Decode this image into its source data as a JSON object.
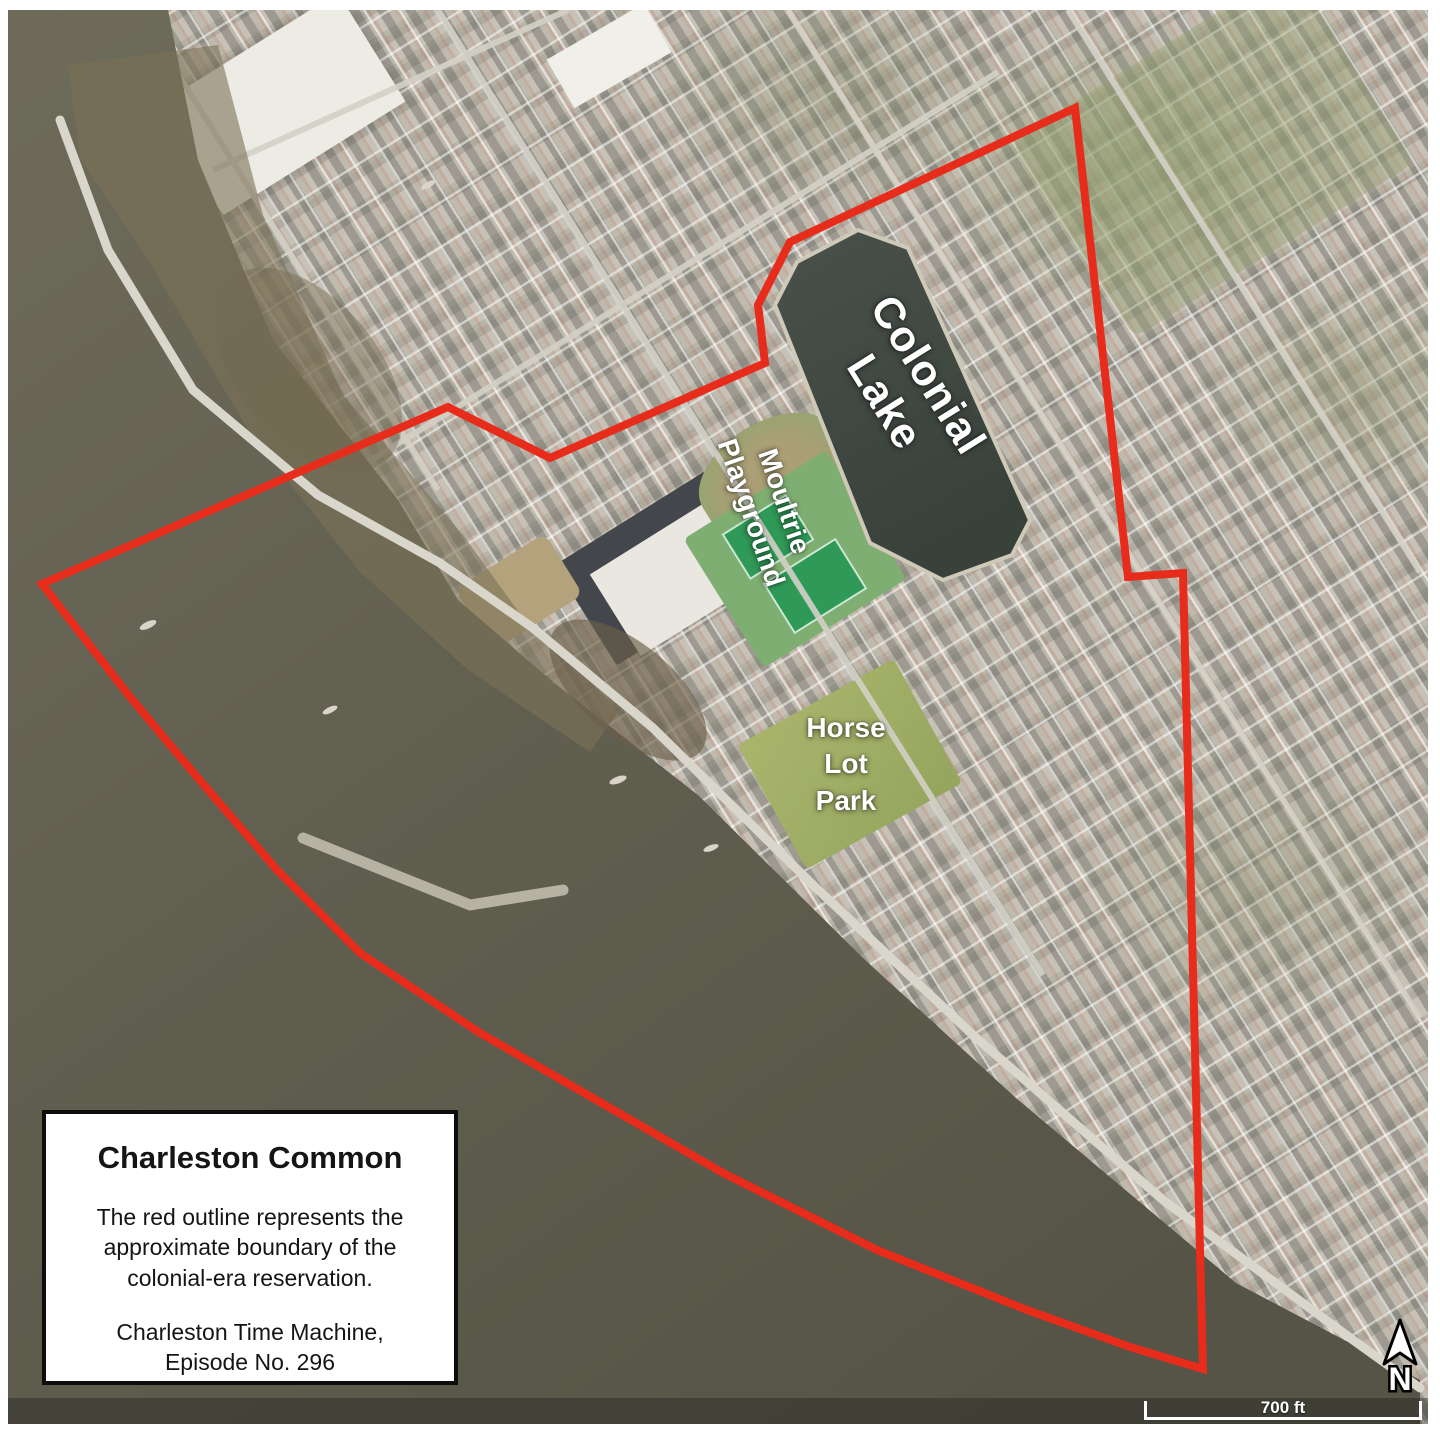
{
  "map": {
    "labels": {
      "colonial_lake": {
        "line1": "Colonial",
        "line2": "Lake",
        "color": "#ffffff",
        "rotation_deg": 58
      },
      "moultrie": {
        "line1": "Moultrie",
        "line2": "Playground",
        "color": "#ffffff",
        "rotation_deg": 71
      },
      "horse_lot": {
        "line1": "Horse",
        "line2": "Lot",
        "line3": "Park",
        "color": "#ffffff",
        "rotation_deg": 0
      }
    },
    "north_indicator": {
      "letter": "N"
    },
    "scale_bar": {
      "label": "700 ft"
    },
    "boundary": {
      "color": "#e82c1b",
      "points": "1067,98 1120,567 1175,563 1195,1359 1122,1337 1019,1300 869,1240 715,1163 552,1069 472,1023 352,943 269,860 189,767 122,687 34,574 440,397 542,448 757,353 750,295 782,232"
    },
    "geometry": {
      "water_points": "0,0 160,0 190,150 265,330 390,490 450,590 545,672 690,785 855,948 1008,1088 1228,1273 1412,1370 1412,1414 0,1414",
      "marsh_points": "60,55 210,35 255,205 335,385 455,525 520,615 612,700 582,742 460,660 350,560 240,420 140,250 72,148",
      "lake_points": "850,220 900,238 1022,510 1004,545 935,570 862,533 767,295 789,252"
    },
    "colors": {
      "water": "#63614f",
      "water_deep": "#555446",
      "marsh": "#7b7156",
      "city_base": "#c6c2b7",
      "lake": "#3e463f",
      "park_green": "#a2af68",
      "court_green": "#2f9a57",
      "road": "#d4d1c7"
    }
  },
  "info_box": {
    "title": "Charleston Common",
    "body_line1": "The red outline represents the",
    "body_line2": "approximate boundary of the",
    "body_line3": "colonial-era reservation.",
    "credit_line1": "Charleston Time Machine,",
    "credit_line2": "Episode No. 296"
  }
}
